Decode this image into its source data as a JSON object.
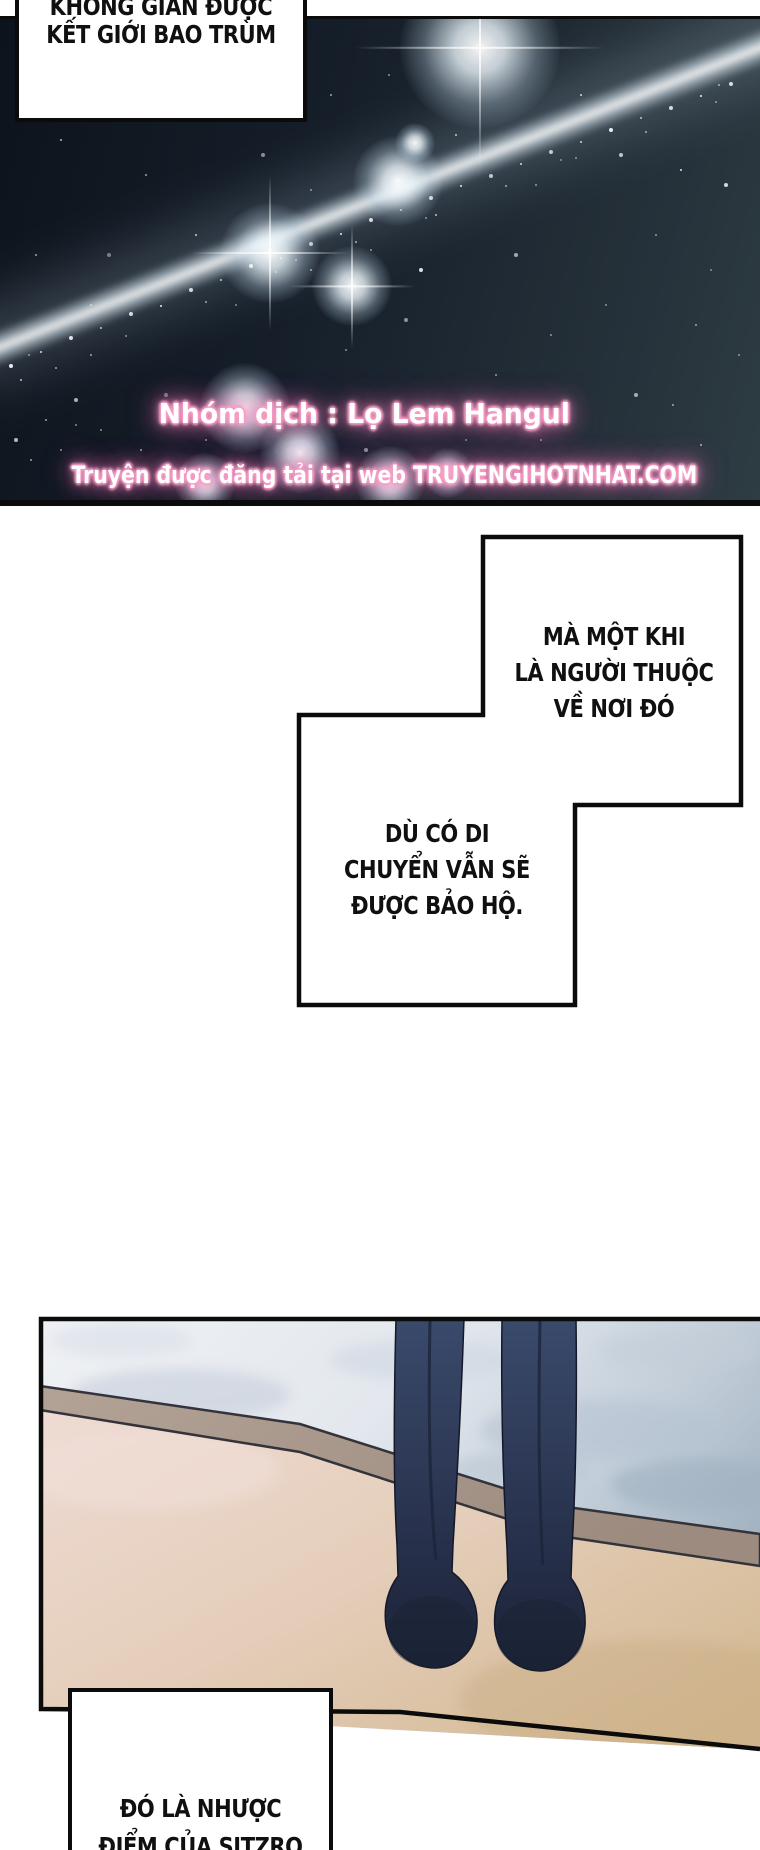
{
  "speech": {
    "opening": [
      "KHÔNG GIAN ĐƯỢC",
      "KẾT GIỚI BAO TRÙM"
    ],
    "belonging": [
      "MÀ MỘT KHI",
      "LÀ NGƯỜI THUỘC",
      "VỀ NƠI ĐÓ"
    ],
    "protected": [
      "DÙ CÓ DI",
      "CHUYỂN VẪN SẼ",
      "ĐƯỢC BẢO HỘ."
    ],
    "weakness": [
      "ĐÓ LÀ NHƯỢC",
      "ĐIỂM CỦA SITZRO"
    ]
  },
  "credits": {
    "group": "Nhóm dịch : Lọ Lem Hangul",
    "site": "Truyện được đăng tải tại web TRUYENGIHOTNHAT.COM"
  },
  "colors": {
    "credit_core": "#ffffff",
    "credit_glow": "#f472b6",
    "sky_dark": "#0d131c",
    "sky_light_edge": "#2e3c43",
    "water": "#e3e8ee",
    "cliff_band": "#a8978b",
    "sand_pink": "#ecd8d0",
    "sand_tan": "#d6bd9b",
    "legs_navy": "#273149",
    "panel_border": "#0b0b0b"
  }
}
